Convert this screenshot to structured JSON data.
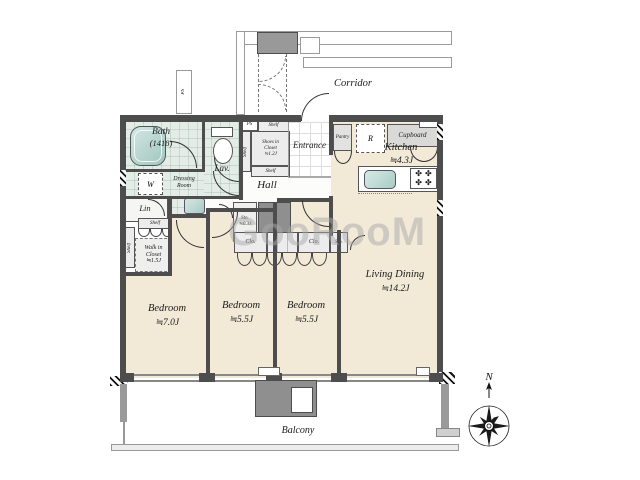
{
  "watermark": "GooRooM",
  "compass": {
    "north": "N"
  },
  "corridor": {
    "label": "Corridor",
    "ps_shaft": "PS"
  },
  "entry": {
    "entrance": "Entrance",
    "hall": "Hall",
    "ps": "PS",
    "shelf_top": "Shelf",
    "shelf_side": "Shelf",
    "shelf_bottom": "Shelf",
    "shoes_closet": {
      "line1": "Shoes in",
      "line2": "Closet",
      "line3": "≒1.2J"
    }
  },
  "wet": {
    "bath": {
      "name": "Bath",
      "size": "(1418)"
    },
    "lav": "Lav.",
    "washer": "W",
    "dressing": {
      "line1": "Dressing",
      "line2": "Room"
    },
    "linen": "Lin"
  },
  "storage": {
    "shelf_top": "Shelf",
    "shelf_side": "Shelf",
    "walkin": {
      "line1": "Walk in",
      "line2": "Closet",
      "line3": "≒1.5J"
    },
    "sto_hall": {
      "line1": "Sto.",
      "line2": "≒0.3J"
    },
    "clo1": "Clo.",
    "clo2": "Clo.",
    "sto_strip": "Sto."
  },
  "kitchen": {
    "name": "Kitchen",
    "size": "≒4.3J",
    "pantry": "Pantry",
    "fridge": "R",
    "cupboard": "Cupboard",
    "ps": "PS"
  },
  "rooms": {
    "living": {
      "name": "Living Dining",
      "size": "≒14.2J"
    },
    "bedroom1": {
      "name": "Bedroom",
      "size": "≒7.0J"
    },
    "bedroom2": {
      "name": "Bedroom",
      "size": "≒5.5J"
    },
    "bedroom3": {
      "name": "Bedroom",
      "size": "≒5.5J"
    },
    "balcony": "Balcony"
  },
  "colors": {
    "wall": "#4d4d4d",
    "floor": "#f2e9d7",
    "wet_floor": "#e3ece7",
    "tub": "#bcd8d4",
    "gray_fill": "#8f8f8f",
    "watermark": "#aaaaaa"
  }
}
